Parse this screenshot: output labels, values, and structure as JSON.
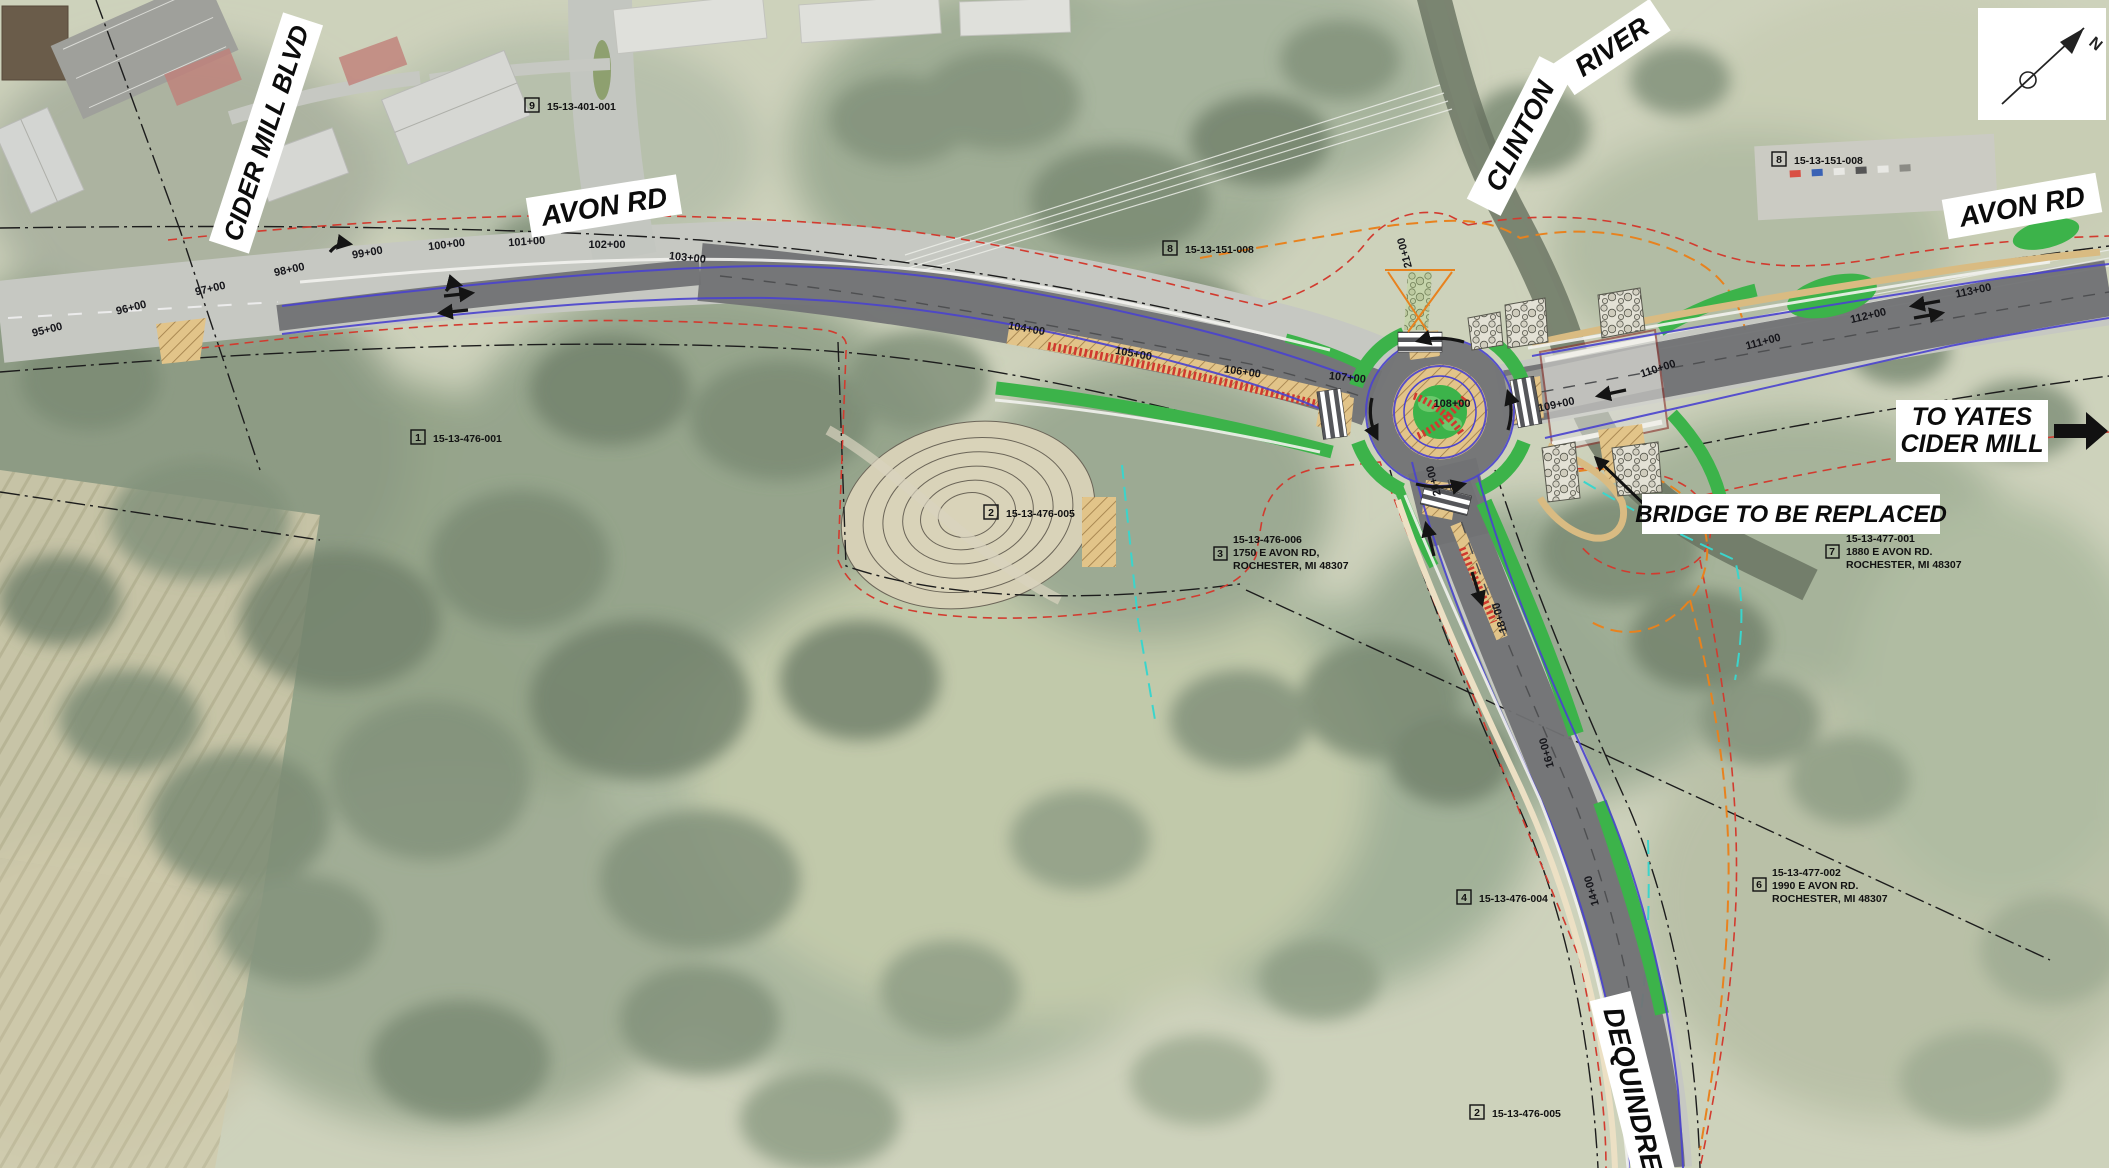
{
  "map": {
    "road_labels": {
      "cider_mill": "CIDER MILL BLVD",
      "avon_west": "AVON RD",
      "avon_east": "AVON RD",
      "clinton_word1": "CLINTON",
      "clinton_word2": "RIVER",
      "dequindre": "DEQUINDRE RD"
    },
    "annotations": {
      "to_yates_line1": "TO YATES",
      "to_yates_line2": "CIDER MILL",
      "bridge_note": "BRIDGE TO BE REPLACED"
    },
    "north_arrow": {
      "label": "N"
    },
    "parcels": [
      {
        "num": "9",
        "id": "15-13-401-001"
      },
      {
        "num": "8",
        "id": "15-13-151-008"
      },
      {
        "num": "8",
        "id": "15-13-151-008"
      },
      {
        "num": "1",
        "id": "15-13-476-001"
      },
      {
        "num": "2",
        "id": "15-13-476-005"
      },
      {
        "num": "3",
        "id": "15-13-476-006",
        "addr1": "1750 E AVON RD,",
        "addr2": "ROCHESTER, MI 48307"
      },
      {
        "num": "7",
        "id": "15-13-477-001",
        "addr1": "1880 E AVON RD.",
        "addr2": "ROCHESTER, MI 48307"
      },
      {
        "num": "4",
        "id": "15-13-476-004"
      },
      {
        "num": "6",
        "id": "15-13-477-002",
        "addr1": "1990 E AVON RD.",
        "addr2": "ROCHESTER, MI 48307"
      },
      {
        "num": "2",
        "id": "15-13-476-005"
      }
    ],
    "stations": {
      "avon": [
        "95+00",
        "96+00",
        "97+00",
        "98+00",
        "99+00",
        "100+00",
        "101+00",
        "102+00",
        "103+00",
        "104+00",
        "105+00",
        "106+00",
        "107+00",
        "108+00",
        "109+00",
        "110+00",
        "111+00",
        "112+00",
        "113+00"
      ],
      "dequindre": [
        "21+00",
        "20+00",
        "18+00",
        "16+00",
        "14+00",
        "12+00",
        "10+00"
      ]
    },
    "colors": {
      "proposed_pavement": "#717274",
      "landscape_green": "#3CB34A",
      "median_tan": "#E2C489",
      "stipple_red": "#D0392E",
      "edge_blue": "#4A43CF",
      "grading_orange": "#E8821E",
      "row_red": "#D23B2F",
      "stream_cyan": "#3AD5CC"
    }
  }
}
